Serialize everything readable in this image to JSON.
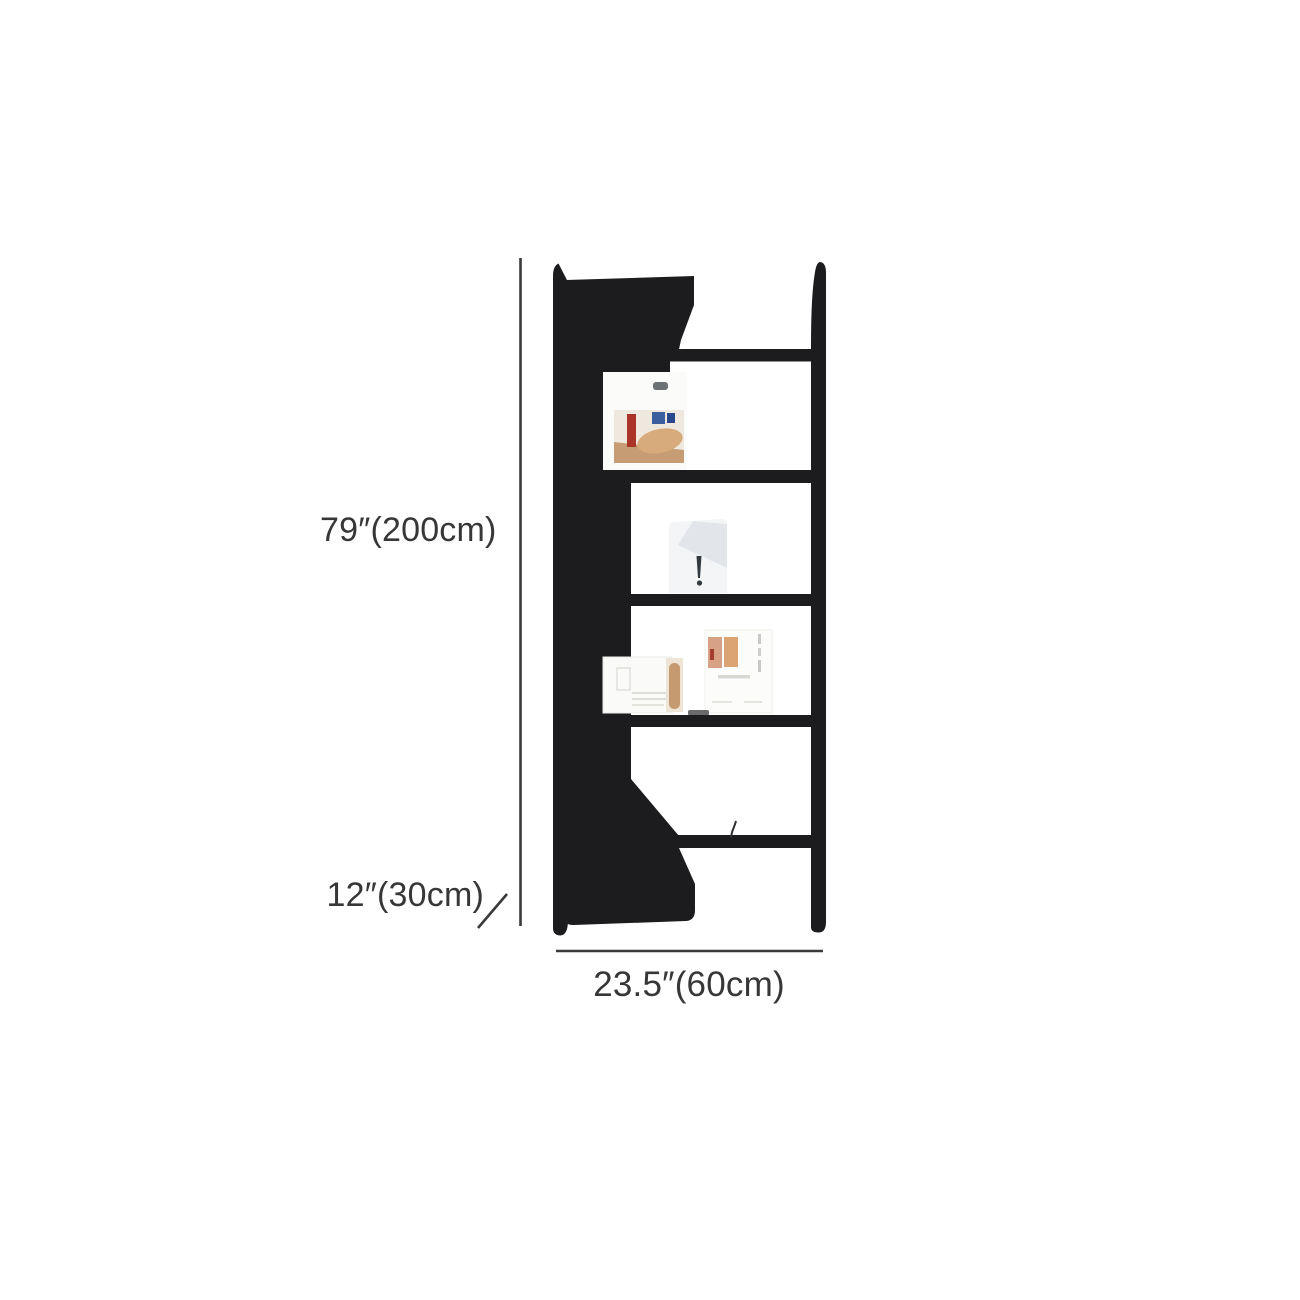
{
  "page": {
    "background_color": "#ffffff"
  },
  "product_diagram": {
    "item": "ladder-bookshelf",
    "frame_color": "#1c1c1e",
    "annotation": {
      "line_color": "#3a3a3a",
      "text_color": "#373737",
      "height_label": "79″(200cm)",
      "depth_label": "12″(30cm)",
      "width_label": "23.5″(60cm)"
    }
  }
}
